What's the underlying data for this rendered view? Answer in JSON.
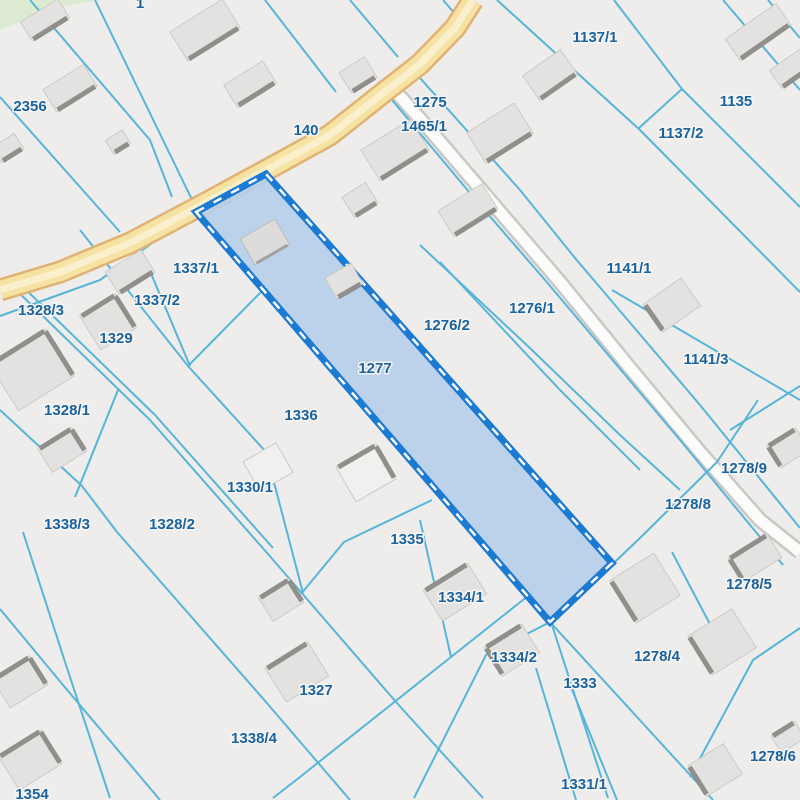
{
  "map": {
    "type": "cadastral-parcel-map",
    "selected_parcel_id": "1277",
    "colors": {
      "background": "#eeedec",
      "parcel_line": "#56b5d8",
      "label_fill": "#1a639e",
      "label_halo": "#f7f6f4",
      "selected_fill": "#b6cfe9",
      "selected_border": "#1b7ad2",
      "selected_dash": "#ffffff",
      "road_yellow_casing": "#e0b273",
      "road_yellow_fill": "#f6e3a4",
      "road_yellow_center": "#faf0cd",
      "road_white_casing": "#c9c8c5",
      "road_white_fill": "#fcfcfb",
      "building_fill": "#e3e2e0",
      "building_stroke": "#c6c5c2",
      "building_bar": "#908f8c",
      "building_white_fill": "#f1f0ee",
      "building_white_stroke": "#c2c1be",
      "green_area": "#dcead2"
    },
    "green_area_points": [
      [
        0,
        0
      ],
      [
        100,
        0
      ],
      [
        55,
        8
      ],
      [
        0,
        30
      ]
    ],
    "roads": {
      "yellow": {
        "name": "140",
        "points": [
          [
            0,
            290
          ],
          [
            60,
            272
          ],
          [
            130,
            243
          ],
          [
            200,
            206
          ],
          [
            270,
            168
          ],
          [
            330,
            135
          ],
          [
            378,
            97
          ],
          [
            420,
            64
          ],
          [
            455,
            28
          ],
          [
            473,
            0
          ]
        ]
      },
      "white": {
        "name": "1465/1",
        "points": [
          [
            396,
            92
          ],
          [
            430,
            130
          ],
          [
            500,
            212
          ],
          [
            560,
            282
          ],
          [
            630,
            368
          ],
          [
            700,
            452
          ],
          [
            760,
            520
          ],
          [
            800,
            552
          ]
        ]
      }
    },
    "selected_parcel": {
      "id": "1277",
      "points": [
        [
          196,
          212
        ],
        [
          266,
          174
        ],
        [
          612,
          563
        ],
        [
          550,
          622
        ]
      ]
    },
    "lines": [
      {
        "p": [
          [
            95,
            0
          ],
          [
            196,
            208
          ]
        ]
      },
      {
        "p": [
          [
            30,
            0
          ],
          [
            150,
            140
          ],
          [
            172,
            197
          ]
        ]
      },
      {
        "p": [
          [
            0,
            97
          ],
          [
            120,
            232
          ]
        ]
      },
      {
        "p": [
          [
            265,
            0
          ],
          [
            336,
            92
          ]
        ]
      },
      {
        "p": [
          [
            350,
            0
          ],
          [
            398,
            57
          ]
        ]
      },
      {
        "p": [
          [
            443,
            0
          ],
          [
            464,
            24
          ]
        ]
      },
      {
        "p": [
          [
            497,
            0
          ],
          [
            640,
            130
          ],
          [
            800,
            292
          ]
        ]
      },
      {
        "p": [
          [
            614,
            0
          ],
          [
            682,
            89
          ]
        ]
      },
      {
        "p": [
          [
            682,
            89
          ],
          [
            800,
            207
          ]
        ]
      },
      {
        "p": [
          [
            682,
            89
          ],
          [
            639,
            128
          ]
        ]
      },
      {
        "p": [
          [
            723,
            0
          ],
          [
            800,
            90
          ]
        ]
      },
      {
        "p": [
          [
            768,
            0
          ],
          [
            800,
            38
          ]
        ]
      },
      {
        "p": [
          [
            392,
            100
          ],
          [
            480,
            205
          ],
          [
            545,
            280
          ],
          [
            680,
            440
          ],
          [
            783,
            565
          ]
        ]
      },
      {
        "p": [
          [
            420,
            78
          ],
          [
            520,
            190
          ],
          [
            575,
            258
          ],
          [
            700,
            405
          ],
          [
            800,
            528
          ]
        ]
      },
      {
        "p": [
          [
            612,
            290
          ],
          [
            800,
            400
          ]
        ]
      },
      {
        "p": [
          [
            730,
            430
          ],
          [
            800,
            386
          ]
        ]
      },
      {
        "p": [
          [
            758,
            400
          ],
          [
            717,
            462
          ],
          [
            640,
            538
          ],
          [
            552,
            622
          ]
        ]
      },
      {
        "p": [
          [
            550,
            622
          ],
          [
            486,
            655
          ],
          [
            414,
            798
          ]
        ]
      },
      {
        "p": [
          [
            533,
            592
          ],
          [
            451,
            657
          ],
          [
            300,
            777
          ],
          [
            273,
            798
          ]
        ]
      },
      {
        "p": [
          [
            432,
            500
          ],
          [
            344,
            542
          ],
          [
            301,
            594
          ]
        ]
      },
      {
        "p": [
          [
            142,
            252
          ],
          [
            190,
            366
          ]
        ]
      },
      {
        "p": [
          [
            188,
            366
          ],
          [
            263,
            290
          ]
        ]
      },
      {
        "p": [
          [
            80,
            230
          ],
          [
            188,
            366
          ],
          [
            266,
            452
          ],
          [
            303,
            593
          ]
        ]
      },
      {
        "p": [
          [
            13,
            287
          ],
          [
            150,
            420
          ],
          [
            268,
            554
          ],
          [
            396,
            702
          ],
          [
            483,
            798
          ]
        ]
      },
      {
        "p": [
          [
            18,
            282
          ],
          [
            155,
            415
          ],
          [
            273,
            548
          ]
        ]
      },
      {
        "p": [
          [
            0,
            410
          ],
          [
            82,
            486
          ],
          [
            117,
            532
          ],
          [
            266,
            702
          ],
          [
            350,
            800
          ]
        ]
      },
      {
        "p": [
          [
            0,
            609
          ],
          [
            63,
            685
          ],
          [
            160,
            800
          ]
        ]
      },
      {
        "p": [
          [
            23,
            532
          ],
          [
            66,
            665
          ],
          [
            110,
            798
          ]
        ]
      },
      {
        "p": [
          [
            118,
            390
          ],
          [
            75,
            497
          ]
        ]
      },
      {
        "p": [
          [
            0,
            316
          ],
          [
            100,
            280
          ],
          [
            196,
            212
          ]
        ]
      },
      {
        "p": [
          [
            420,
            245
          ],
          [
            533,
            351
          ],
          [
            620,
            435
          ],
          [
            680,
            490
          ]
        ]
      },
      {
        "p": [
          [
            440,
            262
          ],
          [
            560,
            390
          ],
          [
            640,
            470
          ]
        ]
      },
      {
        "p": [
          [
            420,
            520
          ],
          [
            451,
            657
          ]
        ]
      },
      {
        "p": [
          [
            550,
            622
          ],
          [
            713,
            800
          ]
        ]
      },
      {
        "p": [
          [
            552,
            625
          ],
          [
            608,
            798
          ]
        ]
      },
      {
        "p": [
          [
            536,
            668
          ],
          [
            576,
            800
          ]
        ]
      },
      {
        "p": [
          [
            571,
            687
          ],
          [
            617,
            800
          ]
        ]
      },
      {
        "p": [
          [
            690,
            777
          ],
          [
            753,
            660
          ],
          [
            800,
            628
          ]
        ]
      },
      {
        "p": [
          [
            672,
            552
          ],
          [
            712,
            628
          ]
        ]
      }
    ],
    "buildings": [
      {
        "cx": 45,
        "cy": 20,
        "w": 44,
        "h": 22,
        "rot": -32,
        "bar": "s"
      },
      {
        "cx": 70,
        "cy": 88,
        "w": 48,
        "h": 26,
        "rot": -32,
        "bar": "s"
      },
      {
        "cx": 205,
        "cy": 30,
        "w": 62,
        "h": 34,
        "rot": -32,
        "bar": "s"
      },
      {
        "cx": 250,
        "cy": 84,
        "w": 46,
        "h": 26,
        "rot": -32,
        "bar": "s"
      },
      {
        "cx": 118,
        "cy": 142,
        "w": 20,
        "h": 16,
        "rot": -32,
        "bar": "s"
      },
      {
        "cx": 8,
        "cy": 148,
        "w": 26,
        "h": 18,
        "rot": -32,
        "bar": "s"
      },
      {
        "cx": 358,
        "cy": 75,
        "w": 30,
        "h": 24,
        "rot": -32,
        "bar": "s"
      },
      {
        "cx": 500,
        "cy": 133,
        "w": 56,
        "h": 36,
        "rot": -32,
        "bar": "s"
      },
      {
        "cx": 395,
        "cy": 150,
        "w": 58,
        "h": 36,
        "rot": -32,
        "bar": "s"
      },
      {
        "cx": 360,
        "cy": 200,
        "w": 28,
        "h": 24,
        "rot": -32,
        "bar": "s"
      },
      {
        "cx": 468,
        "cy": 210,
        "w": 52,
        "h": 30,
        "rot": -32,
        "bar": "s"
      },
      {
        "cx": 550,
        "cy": 75,
        "w": 46,
        "h": 30,
        "rot": -35,
        "bar": "s"
      },
      {
        "cx": 758,
        "cy": 32,
        "w": 62,
        "h": 26,
        "rot": -35,
        "bar": "s"
      },
      {
        "cx": 792,
        "cy": 68,
        "w": 40,
        "h": 22,
        "rot": -35,
        "bar": "s"
      },
      {
        "cx": 672,
        "cy": 305,
        "w": 46,
        "h": 34,
        "rot": -35,
        "bar": "w"
      },
      {
        "cx": 130,
        "cy": 272,
        "w": 42,
        "h": 26,
        "rot": -32,
        "bar": "s"
      },
      {
        "cx": 108,
        "cy": 322,
        "w": 42,
        "h": 40,
        "rot": -32,
        "bar": "ne"
      },
      {
        "cx": 32,
        "cy": 370,
        "w": 66,
        "h": 55,
        "rot": -32,
        "bar": "ne"
      },
      {
        "cx": 62,
        "cy": 450,
        "w": 40,
        "h": 28,
        "rot": -32,
        "bar": "ne"
      },
      {
        "cx": 265,
        "cy": 242,
        "w": 40,
        "h": 30,
        "rot": -30,
        "bar": "s",
        "style": "inner"
      },
      {
        "cx": 344,
        "cy": 281,
        "w": 30,
        "h": 24,
        "rot": -30,
        "bar": "s"
      },
      {
        "cx": 268,
        "cy": 467,
        "w": 38,
        "h": 34,
        "rot": -30,
        "bar": "",
        "style": "white"
      },
      {
        "cx": 366,
        "cy": 473,
        "w": 46,
        "h": 40,
        "rot": -30,
        "bar": "ne",
        "style": "white"
      },
      {
        "cx": 455,
        "cy": 592,
        "w": 52,
        "h": 36,
        "rot": -32,
        "bar": "n"
      },
      {
        "cx": 512,
        "cy": 650,
        "w": 44,
        "h": 34,
        "rot": -32,
        "bar": "nw"
      },
      {
        "cx": 297,
        "cy": 672,
        "w": 50,
        "h": 40,
        "rot": -32,
        "bar": "n"
      },
      {
        "cx": 281,
        "cy": 600,
        "w": 36,
        "h": 28,
        "rot": -32,
        "bar": "ne"
      },
      {
        "cx": 645,
        "cy": 588,
        "w": 52,
        "h": 50,
        "rot": -32,
        "bar": "w"
      },
      {
        "cx": 722,
        "cy": 642,
        "w": 52,
        "h": 46,
        "rot": -32,
        "bar": "w"
      },
      {
        "cx": 755,
        "cy": 558,
        "w": 46,
        "h": 28,
        "rot": -32,
        "bar": "nw"
      },
      {
        "cx": 715,
        "cy": 770,
        "w": 42,
        "h": 36,
        "rot": -32,
        "bar": "w"
      },
      {
        "cx": 788,
        "cy": 737,
        "w": 28,
        "h": 20,
        "rot": -32,
        "bar": "n"
      },
      {
        "cx": 788,
        "cy": 448,
        "w": 34,
        "h": 26,
        "rot": -32,
        "bar": "nw"
      },
      {
        "cx": 20,
        "cy": 682,
        "w": 44,
        "h": 34,
        "rot": -32,
        "bar": "ne"
      },
      {
        "cx": 30,
        "cy": 760,
        "w": 50,
        "h": 40,
        "rot": -32,
        "bar": "ne"
      }
    ],
    "labels": [
      {
        "text": "1",
        "x": 140,
        "y": 8
      },
      {
        "text": "2356",
        "x": 30,
        "y": 111
      },
      {
        "text": "140",
        "x": 306,
        "y": 135
      },
      {
        "text": "1275",
        "x": 430,
        "y": 107
      },
      {
        "text": "1465/1",
        "x": 424,
        "y": 131
      },
      {
        "text": "1137/1",
        "x": 595,
        "y": 42
      },
      {
        "text": "1135",
        "x": 736,
        "y": 106
      },
      {
        "text": "1137/2",
        "x": 681,
        "y": 138
      },
      {
        "text": "1141/1",
        "x": 629,
        "y": 273
      },
      {
        "text": "1141/3",
        "x": 706,
        "y": 364
      },
      {
        "text": "1337/1",
        "x": 196,
        "y": 273
      },
      {
        "text": "1337/2",
        "x": 157,
        "y": 305
      },
      {
        "text": "1328/3",
        "x": 41,
        "y": 315
      },
      {
        "text": "1329",
        "x": 116,
        "y": 343
      },
      {
        "text": "1276/2",
        "x": 447,
        "y": 330
      },
      {
        "text": "1276/1",
        "x": 532,
        "y": 313
      },
      {
        "text": "1277",
        "x": 375,
        "y": 373
      },
      {
        "text": "1336",
        "x": 301,
        "y": 420
      },
      {
        "text": "1328/1",
        "x": 67,
        "y": 415
      },
      {
        "text": "1330/1",
        "x": 250,
        "y": 492
      },
      {
        "text": "1338/3",
        "x": 67,
        "y": 529
      },
      {
        "text": "1328/2",
        "x": 172,
        "y": 529
      },
      {
        "text": "1335",
        "x": 407,
        "y": 544
      },
      {
        "text": "1334/1",
        "x": 461,
        "y": 602
      },
      {
        "text": "1278/9",
        "x": 744,
        "y": 473
      },
      {
        "text": "1278/8",
        "x": 688,
        "y": 509
      },
      {
        "text": "1278/5",
        "x": 749,
        "y": 589
      },
      {
        "text": "1334/2",
        "x": 514,
        "y": 662
      },
      {
        "text": "1333",
        "x": 580,
        "y": 688
      },
      {
        "text": "1278/4",
        "x": 657,
        "y": 661
      },
      {
        "text": "1327",
        "x": 316,
        "y": 695
      },
      {
        "text": "1338/4",
        "x": 254,
        "y": 743
      },
      {
        "text": "1278/6",
        "x": 773,
        "y": 761
      },
      {
        "text": "1331/1",
        "x": 584,
        "y": 789
      },
      {
        "text": "1354",
        "x": 32,
        "y": 799
      }
    ]
  }
}
